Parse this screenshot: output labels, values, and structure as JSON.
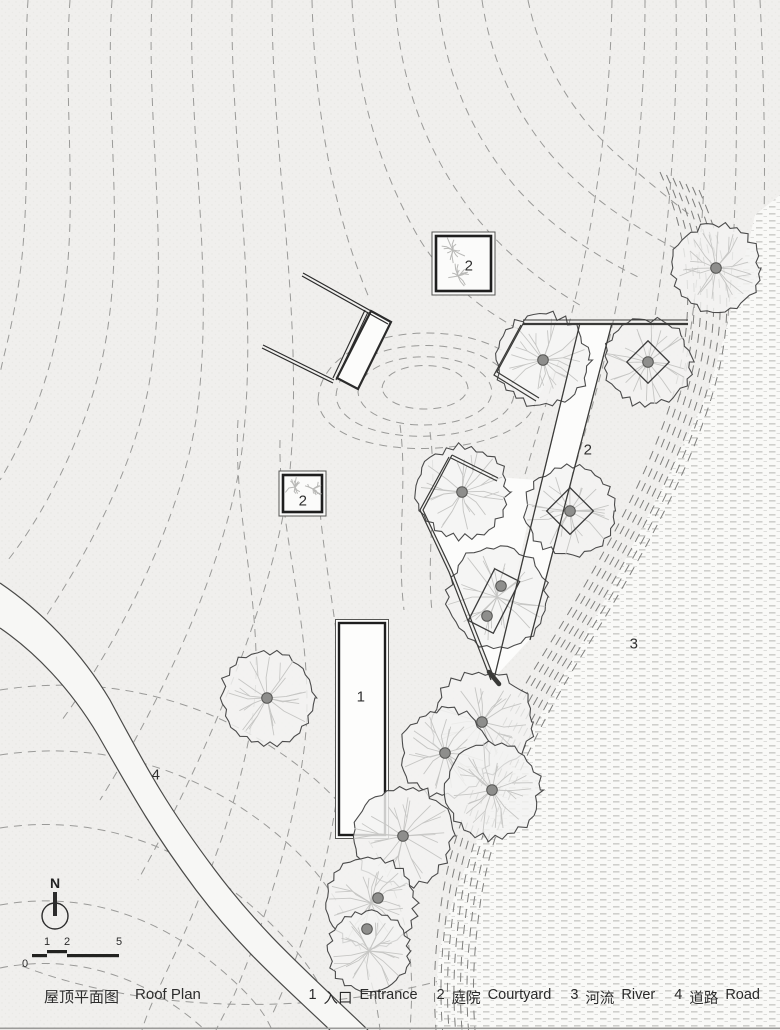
{
  "title": {
    "zh": "屋顶平面图",
    "en": "Roof Plan"
  },
  "legend": {
    "items": [
      {
        "num": "1",
        "zh": "入口",
        "en": "Entrance"
      },
      {
        "num": "2",
        "zh": "庭院",
        "en": "Courtyard"
      },
      {
        "num": "3",
        "zh": "河流",
        "en": "River"
      },
      {
        "num": "4",
        "zh": "道路",
        "en": "Road"
      }
    ]
  },
  "plan_labels": {
    "building": "1",
    "courtyard_a": "2",
    "courtyard_b": "2",
    "courtyard_strip": "2",
    "river": "3",
    "road": "4"
  },
  "north": {
    "label": "N"
  },
  "scale_bar": {
    "ticks": [
      "0",
      "1",
      "2",
      "5"
    ]
  },
  "colors": {
    "paper": "#f0efed",
    "line_dark": "#2e2e2e",
    "contour": "#9a9a98",
    "tree_outline": "#4b4b4b",
    "branch": "#c6c6c4",
    "trunk": "#8e8e8c",
    "trunk_edge": "#565654",
    "square_line": "#3c3c3c",
    "sprig": "#b9b9b7"
  },
  "diagram": {
    "trees": [
      {
        "x": 716,
        "y": 268,
        "r": 46
      },
      {
        "x": 543,
        "y": 360,
        "r": 48
      },
      {
        "x": 648,
        "y": 362,
        "r": 45
      },
      {
        "x": 462,
        "y": 492,
        "r": 48
      },
      {
        "x": 570,
        "y": 511,
        "r": 46
      },
      {
        "x": 497,
        "y": 597,
        "r": 52,
        "tx": 501,
        "ty": 586,
        "t2x": 487,
        "t2y": 616
      },
      {
        "x": 482,
        "y": 722,
        "r": 52
      },
      {
        "x": 445,
        "y": 753,
        "r": 46
      },
      {
        "x": 492,
        "y": 790,
        "r": 50
      },
      {
        "x": 403,
        "y": 836,
        "r": 52
      },
      {
        "x": 371,
        "y": 903,
        "r": 47,
        "tx": 378,
        "ty": 898
      },
      {
        "x": 369,
        "y": 951,
        "r": 42,
        "tx": 367,
        "ty": 929
      },
      {
        "x": 267,
        "y": 698,
        "r": 48
      }
    ],
    "tree_squares": [
      {
        "x": 648,
        "y": 362,
        "w": 30,
        "h": 30,
        "rot": 45
      },
      {
        "x": 570,
        "y": 511,
        "w": 33,
        "h": 33,
        "rot": 45
      },
      {
        "x": 494,
        "y": 601,
        "w": 28,
        "h": 58,
        "rot": 27
      }
    ],
    "sprigs": [
      {
        "x": 453,
        "y": 250,
        "r": 14
      },
      {
        "x": 458,
        "y": 276,
        "r": 13
      },
      {
        "x": 295,
        "y": 487,
        "r": 11
      },
      {
        "x": 313,
        "y": 489,
        "r": 10
      }
    ]
  }
}
